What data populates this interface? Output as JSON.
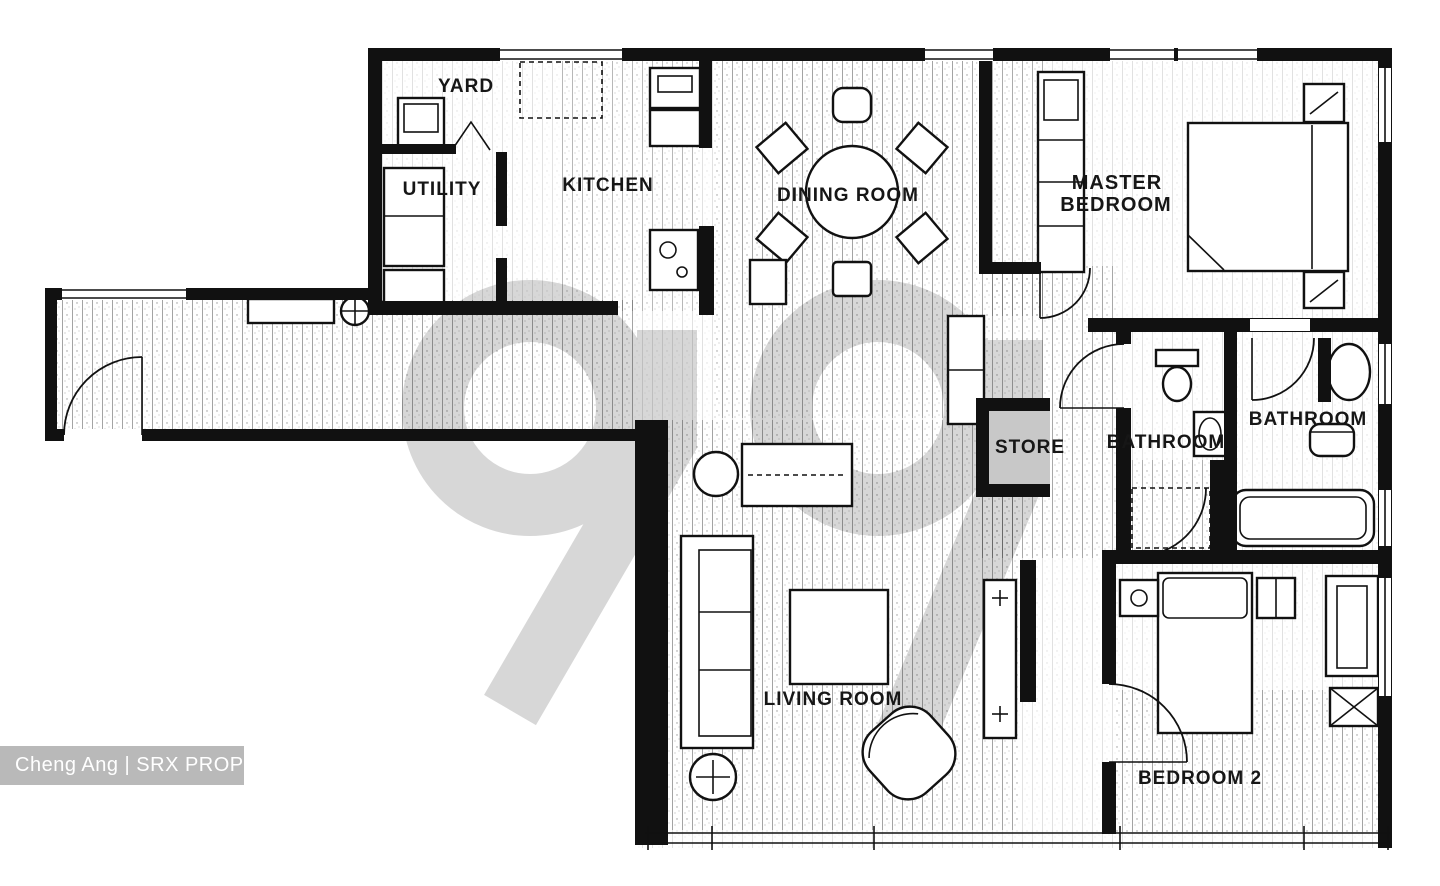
{
  "image": {
    "kind": "scanned floor plan",
    "width": 1440,
    "height": 886
  },
  "watermark": {
    "text": "99"
  },
  "credit": {
    "text": "Cheng Ang | SRX PROPERTY"
  },
  "colors": {
    "wall": "#111111",
    "watermark_gray": "#d7d7d7",
    "store_fill": "#c8c8c8",
    "credit_bg": "#b9b9b9",
    "credit_text": "#ffffff",
    "paper": "#ffffff"
  },
  "rooms": {
    "yard": {
      "label": "YARD"
    },
    "utility": {
      "label": "UTILITY"
    },
    "kitchen": {
      "label": "KITCHEN"
    },
    "dining": {
      "label": "DINING ROOM"
    },
    "master": {
      "label_line1": "MASTER",
      "label_line2": "BEDROOM"
    },
    "store": {
      "label": "STORE"
    },
    "bathroom_common": {
      "label": "BATHROOM"
    },
    "bathroom_master": {
      "label": "BATHROOM"
    },
    "living": {
      "label": "LIVING ROOM"
    },
    "bedroom2": {
      "label": "BEDROOM 2"
    }
  }
}
